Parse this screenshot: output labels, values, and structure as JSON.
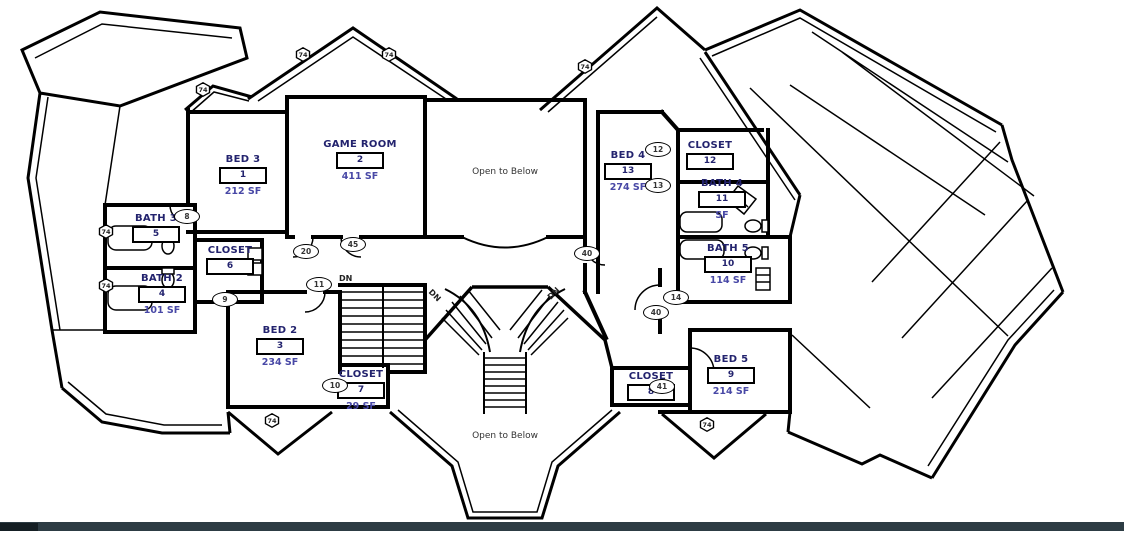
{
  "drawing": {
    "kind": "second floor plan",
    "colors": {
      "room_label": "#23236e",
      "area_label": "#4848a6",
      "wall": "#000000",
      "marker_text": "#333333",
      "footer_bar": "#2d3c44"
    }
  },
  "rooms": [
    {
      "id": "bed-3",
      "name": "BED 3",
      "tag": "1",
      "area": "212 SF"
    },
    {
      "id": "game-room",
      "name": "GAME ROOM",
      "tag": "2",
      "area": "411 SF"
    },
    {
      "id": "bed-2",
      "name": "BED 2",
      "tag": "3",
      "area": "234 SF"
    },
    {
      "id": "bath-2",
      "name": "BATH 2",
      "tag": "4",
      "area": "101 SF"
    },
    {
      "id": "bath-3",
      "name": "BATH 3",
      "tag": "5",
      "area": ""
    },
    {
      "id": "closet-6",
      "name": "CLOSET",
      "tag": "6",
      "area": ""
    },
    {
      "id": "closet-7",
      "name": "CLOSET",
      "tag": "7",
      "area": "29 SF"
    },
    {
      "id": "closet-8",
      "name": "CLOSET",
      "tag": "8",
      "area": ""
    },
    {
      "id": "bed-5",
      "name": "BED 5",
      "tag": "9",
      "area": "214 SF"
    },
    {
      "id": "bath-5",
      "name": "BATH 5",
      "tag": "10",
      "area": "114 SF"
    },
    {
      "id": "bath-4",
      "name": "BATH 4",
      "tag": "11",
      "area": "SF"
    },
    {
      "id": "closet-12",
      "name": "CLOSET",
      "tag": "12",
      "area": ""
    },
    {
      "id": "bed-4",
      "name": "BED 4",
      "tag": "13",
      "area": "274 SF"
    }
  ],
  "annotations": {
    "open_to_below": "Open to Below",
    "down": "DN"
  },
  "markers": {
    "window_tag": "74",
    "door_tags": [
      "8",
      "9",
      "10",
      "11",
      "12",
      "13",
      "14",
      "20",
      "40",
      "41",
      "45"
    ]
  }
}
